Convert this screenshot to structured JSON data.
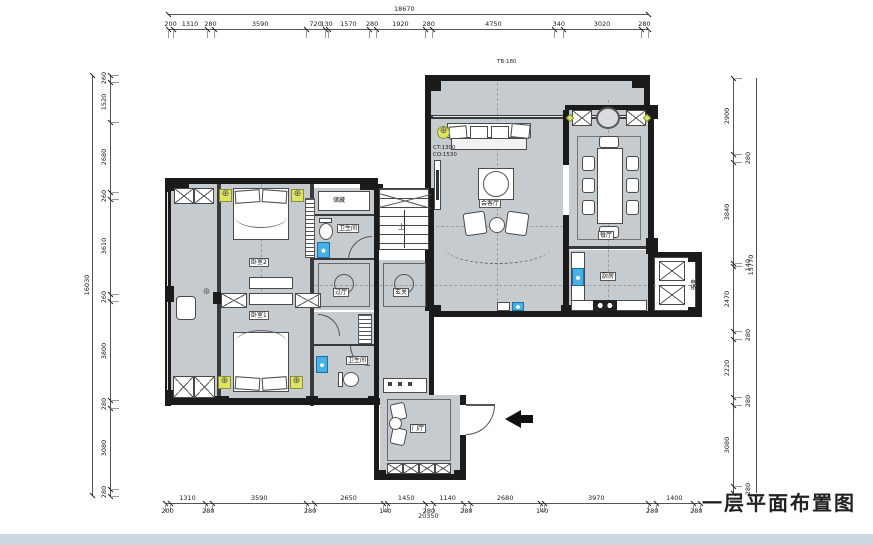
{
  "title": "一层平面布置图",
  "notes": {
    "tb": "TB:180",
    "ct": "CT:1300",
    "co": "CO:1530"
  },
  "icons": {
    "lamp": "⊕"
  },
  "rooms": {
    "living": "会客厅",
    "dining": "餐厅",
    "kitchen": "厨房",
    "bedroom2": "卧室2",
    "bedroom1": "卧室1",
    "bath_upper": "卫生间",
    "bath_lower": "卫生间",
    "storage": "储藏",
    "hall": "过厅",
    "foyer": "玄关",
    "entry": "门厅",
    "stairs_up": "上",
    "elevator": "电梯"
  },
  "dims": {
    "top": {
      "total": "18670",
      "segments": [
        200,
        1310,
        280,
        3590,
        720,
        130,
        1570,
        280,
        1920,
        280,
        4750,
        340,
        3020,
        280
      ]
    },
    "bottom": {
      "total": "20350",
      "segments": [
        200,
        1310,
        280,
        3590,
        280,
        2650,
        140,
        1450,
        280,
        1140,
        280,
        2680,
        140,
        3970,
        280,
        1400,
        280
      ]
    },
    "left": {
      "total": "16030",
      "segments": [
        260,
        1520,
        2680,
        260,
        3610,
        260,
        3800,
        280,
        3080,
        280
      ]
    },
    "right": {
      "total": "15770",
      "segments": [
        2900,
        280,
        3840,
        140,
        2470,
        280,
        2220,
        280,
        3080,
        280
      ]
    }
  }
}
